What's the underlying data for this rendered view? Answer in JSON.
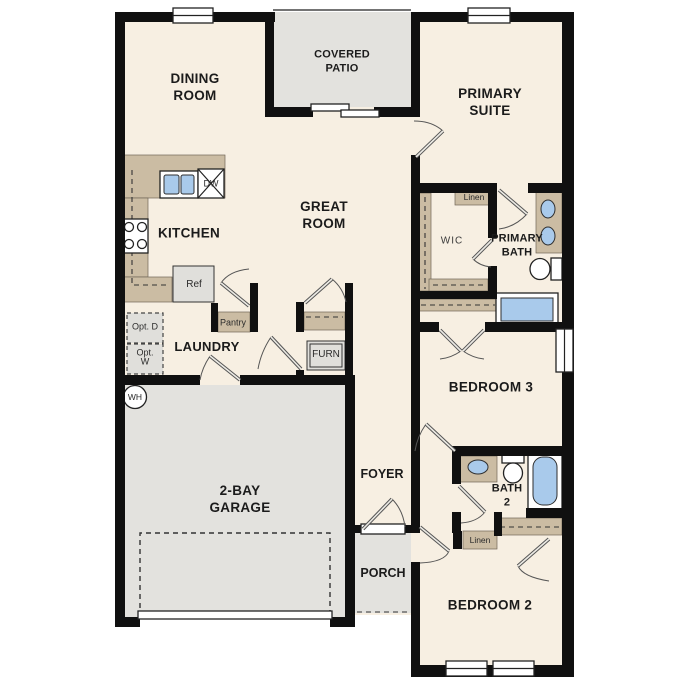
{
  "title": "Single-story floor plan",
  "colors": {
    "wall": "#101010",
    "floor": "#f7efe2",
    "outdoor": "#e3e2de",
    "tan": "#cbbca3",
    "blue": "#a9caeb",
    "appl": "#e0dfdb"
  },
  "rooms": {
    "covered_patio": "COVERED PATIO",
    "dining_room": "DINING ROOM",
    "primary_suite": "PRIMARY SUITE",
    "great_room": "GREAT ROOM",
    "kitchen": "KITCHEN",
    "laundry": "LAUNDRY",
    "wic": "WIC",
    "primary_bath": "PRIMARY BATH",
    "bedroom_3": "BEDROOM 3",
    "foyer": "FOYER",
    "bath_2": "BATH 2",
    "garage": "2-BAY GARAGE",
    "porch": "PORCH",
    "bedroom_2": "BEDROOM 2"
  },
  "fixtures": {
    "pantry": "Pantry",
    "furnace": "FURN",
    "refrigerator": "Ref",
    "dishwasher": "DW",
    "linen_wic": "Linen",
    "linen_hall": "Linen",
    "opt_dryer": "Opt. D",
    "opt_washer": "Opt. W",
    "water_heater": "WH"
  }
}
